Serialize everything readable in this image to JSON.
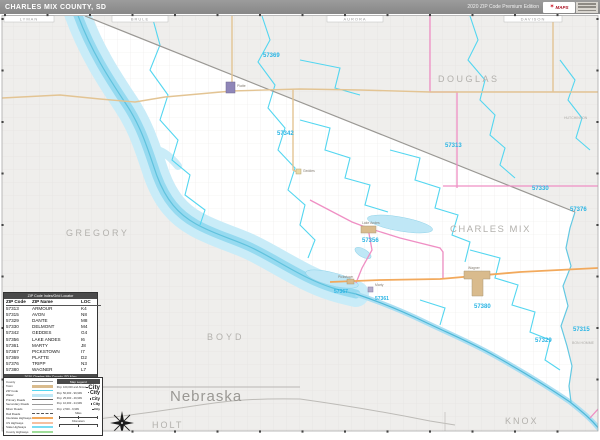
{
  "header": {
    "title": "CHARLES MIX COUNTY, SD",
    "edition": "2020 ZIP Code Premium Edition",
    "logo_text": "MAPS",
    "logo_icon": "star"
  },
  "map": {
    "neighbors_top": {
      "a": "LYMAN",
      "b": "BRULE",
      "c": "AURORA",
      "d": "DAVISON"
    },
    "counties": {
      "douglas": "DOUGLAS",
      "gregory": "GREGORY",
      "charles_mix": "CHARLES MIX",
      "boyd": "BOYD",
      "holt": "HOLT",
      "knox": "KNOX",
      "hutchinson": "HUTCHINSON",
      "bon_homme": "BON HOMME"
    },
    "state": "Nebraska",
    "zips": {
      "z57369": "57369",
      "z57342": "57342",
      "z57313": "57313",
      "z57330": "57330",
      "z57376": "57376",
      "z57356": "57356",
      "z57367": "57367",
      "z57361": "57361",
      "z57380": "57380",
      "z57329": "57329",
      "z57315": "57315"
    },
    "towns": {
      "platte": "Platte",
      "geddes": "Geddes",
      "lake_andes": "Lake Andes",
      "pickstown": "Pickstown",
      "marty": "Marty",
      "wagner": "Wagner"
    }
  },
  "zip_table": {
    "title": "ZIP Code Index/Grid Locator",
    "columns": [
      "ZIP Code",
      "ZIP Name",
      "LOC"
    ],
    "rows": [
      [
        "57313",
        "ARMOUR",
        "K4"
      ],
      [
        "57315",
        "AVON",
        "N8"
      ],
      [
        "57329",
        "DANTE",
        "M8"
      ],
      [
        "57330",
        "DELMONT",
        "M4"
      ],
      [
        "57342",
        "GEDDES",
        "G4"
      ],
      [
        "57356",
        "LAKE ANDES",
        "I6"
      ],
      [
        "57361",
        "MARTY",
        "J8"
      ],
      [
        "57367",
        "PICKSTOWN",
        "I7"
      ],
      [
        "57369",
        "PLATTE",
        "D2"
      ],
      [
        "57376",
        "TRIPP",
        "N3"
      ],
      [
        "57380",
        "WAGNER",
        "L7"
      ]
    ],
    "footer": "2020 Charles Mix County, SD Map"
  },
  "legend": {
    "title": "Map Legend",
    "items": [
      {
        "label": "County"
      },
      {
        "label": "Town"
      },
      {
        "label": "ZIP Code"
      },
      {
        "label": "Water"
      },
      {
        "label": "Primary Roads"
      },
      {
        "label": "Secondary Roads"
      },
      {
        "label": "Minor Roads"
      },
      {
        "label": "Rail Roads"
      },
      {
        "label": "Interstate Highways"
      },
      {
        "label": "US Highways"
      },
      {
        "label": "State Highways"
      },
      {
        "label": "County Highways"
      }
    ],
    "population": [
      {
        "label": "Pop: 100,000 and Above",
        "text": "City"
      },
      {
        "label": "Pop: 50,000 - 99,999",
        "text": "City"
      },
      {
        "label": "Pop: 25,000 - 49,999",
        "text": "City"
      },
      {
        "label": "Pop: 10,000 - 24,999",
        "text": "City"
      },
      {
        "label": "Pop: 2,500 - 9,999",
        "text": "City"
      }
    ],
    "scale": {
      "miles": "Miles",
      "kilometers": "Kilometers"
    }
  },
  "colors": {
    "water": "#c9ecf8",
    "water_deep": "#96daf0",
    "zip_boundary": "#53d6f0",
    "county_boundary_pink": "#ef8fc4",
    "road_major": "#e3c493",
    "road_interstate": "#f2a95c",
    "zip_label": "#29b4e4",
    "county_label": "#b3b1ad",
    "outside_fill": "#efeeec"
  }
}
